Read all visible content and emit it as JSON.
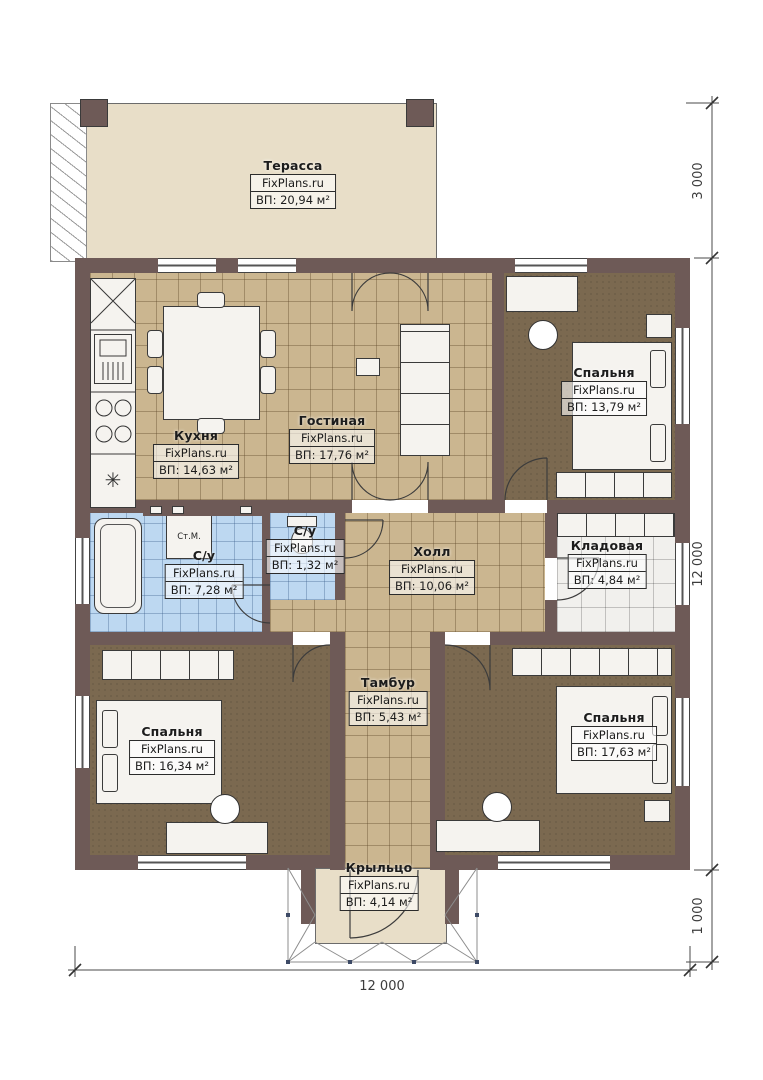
{
  "brand": "FixPlans.ru",
  "rooms": [
    {
      "id": "terrace",
      "name": "Терасса",
      "area": "ВП: 20,94 м²"
    },
    {
      "id": "kitchen",
      "name": "Кухня",
      "area": "ВП: 14,63 м²"
    },
    {
      "id": "living",
      "name": "Гостиная",
      "area": "ВП: 17,76 м²"
    },
    {
      "id": "bedroom-ne",
      "name": "Спальня",
      "area": "ВП: 13,79 м²"
    },
    {
      "id": "wc-small",
      "name": "С/у",
      "area": "ВП: 1,32 м²"
    },
    {
      "id": "bathroom",
      "name": "С/у",
      "area": "ВП: 7,28 м²"
    },
    {
      "id": "hall",
      "name": "Холл",
      "area": "ВП: 10,06 м²"
    },
    {
      "id": "storage",
      "name": "Кладовая",
      "area": "ВП: 4,84 м²"
    },
    {
      "id": "tambour",
      "name": "Тамбур",
      "area": "ВП: 5,43 м²"
    },
    {
      "id": "bedroom-sw",
      "name": "Спальня",
      "area": "ВП: 16,34 м²"
    },
    {
      "id": "bedroom-se",
      "name": "Спальня",
      "area": "ВП: 17,63 м²"
    },
    {
      "id": "porch",
      "name": "Крыльцо",
      "area": "ВП: 4,14 м²"
    }
  ],
  "annotations": {
    "washing_machine": "Ст.М."
  },
  "dimensions": {
    "terrace_depth": "3 000",
    "house_height": "12 000",
    "porch_depth": "1 000",
    "house_width": "12 000"
  },
  "palette": {
    "wall": "#6e5a57",
    "tile_tan": "#cbb690",
    "tile_blue": "#bdd8f1",
    "carpet_brown": "#7b6950",
    "deck_beige": "#e8dec8",
    "storage_tile": "#f1f0ed",
    "line": "#3c3c3c"
  }
}
